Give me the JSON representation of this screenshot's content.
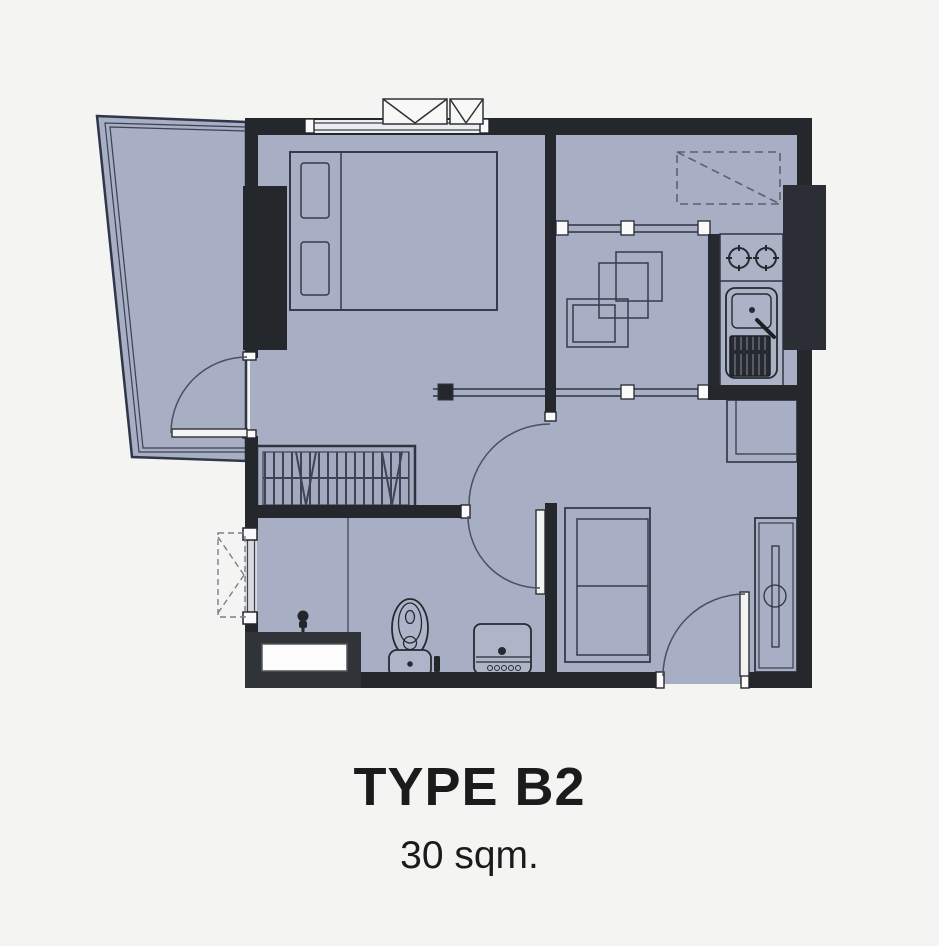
{
  "plan": {
    "title": "TYPE B2",
    "area": "30 sqm."
  },
  "colors": {
    "background": "#f4f4f2",
    "floor": "#a8aec3",
    "wall": "#24272c",
    "outline": "#343a48",
    "glass_jamb_white": "#fafafa",
    "dashed_line": "#5c616c",
    "text": "#1b1b1b"
  }
}
